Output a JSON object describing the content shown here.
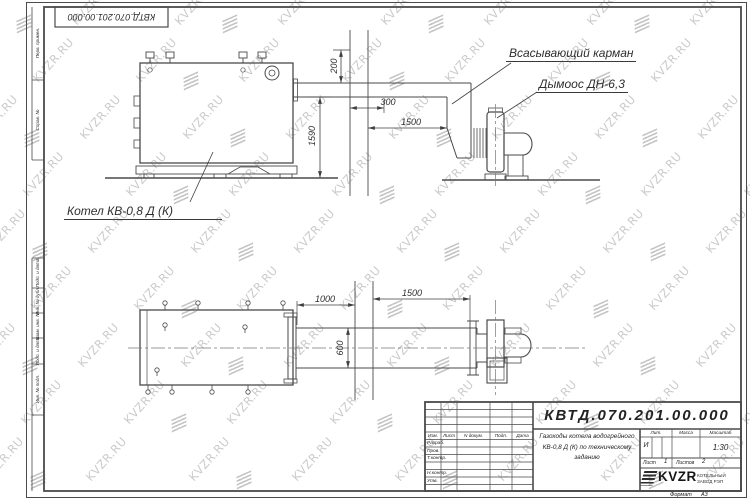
{
  "watermark": {
    "text": "KVZR.RU"
  },
  "frame": {
    "doc_number_top": "КВТД.070.201.00.000",
    "side_labels": [
      "Перв. примен.",
      "Справ. №",
      "Подп. и дата",
      "Инв. № дубл.",
      "Взам. инв. №",
      "Подп. и дата",
      "Инв. № подл."
    ]
  },
  "drawing": {
    "labels": {
      "suction_pocket": "Всасывающий карман",
      "smoke_exhauster": "Дымоос ДН-6,3",
      "boiler": "Котел КВ-0,8 Д (К)"
    },
    "dimensions": {
      "upper_200": "200",
      "upper_300": "300",
      "upper_1500": "1500",
      "upper_1590": "1590",
      "lower_1000": "1000",
      "lower_1500": "1500",
      "lower_600": "600"
    }
  },
  "title_block": {
    "doc_number": "КВТД.070.201.00.000",
    "description": "Газоходы котела водогрейного КВ-0,8 Д (К) по техническому заданию",
    "change_header": {
      "izm": "Изм.",
      "list": "Лист",
      "doc": "N докум.",
      "podp": "Подп.",
      "data": "Дата"
    },
    "signature_rows": [
      "Разраб.",
      "Пров.",
      "Т.контр.",
      "Н.контр.",
      "Утв."
    ],
    "lit_label": "Лит.",
    "lit_value": "И",
    "mass_label": "Масса",
    "scale_label": "Масштаб",
    "scale_value": "1:30",
    "sheet_label": "Лист",
    "sheet_value": "1",
    "sheets_label": "Листов",
    "sheets_value": "2",
    "company_logo_text": "KVZR",
    "company_name_line1": "КОТЕЛЬНЫЙ",
    "company_name_line2": "ЗАВОД РЭП",
    "format_label": "Формат",
    "format_value": "А3"
  }
}
